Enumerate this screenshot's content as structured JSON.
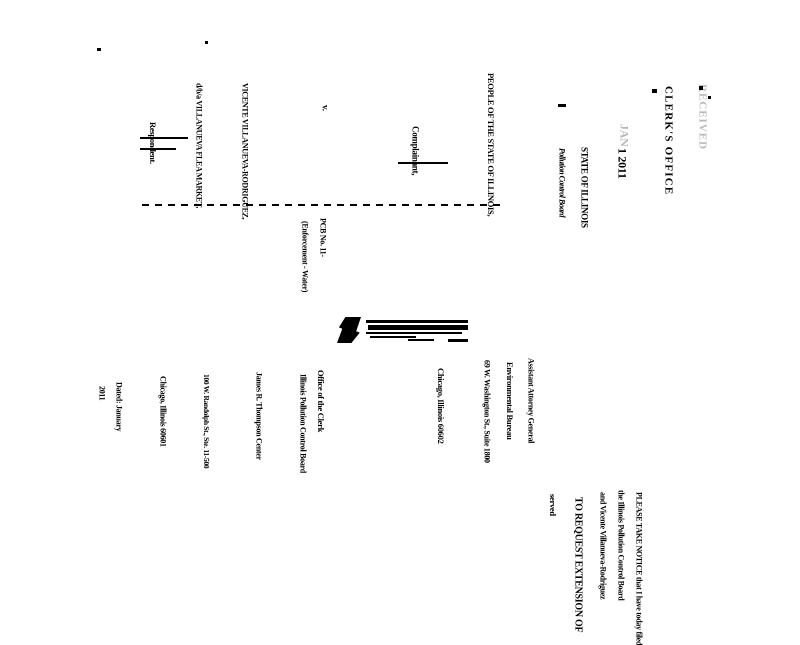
{
  "page": {
    "kind": "scanned legal filing, rotated 90 degrees clockwise",
    "background_color": "#ffffff",
    "ink_color": "#000000"
  },
  "stamp": {
    "received": "RECEIVED",
    "office_line": "CLERK'S OFFICE",
    "date_month": "JAN",
    "date_line": "1 2011",
    "state_line": "STATE OF ILLINOIS",
    "board_line": "Pollution Control Board"
  },
  "caption": {
    "complainant_name": "PEOPLE OF THE STATE OF ILLINOIS,",
    "complainant_label": "Complainant,",
    "versus": "v.",
    "respondent_name": "VICENTE VILLANUEVA-RODRIGUEZ,",
    "respondent_dba": "d/b/a VILLANUEVA FLEA MARKET,",
    "respondent_label": "Respondent."
  },
  "case_ref": {
    "number": "PCB No. 11-",
    "category": "(Enforcement - Water)"
  },
  "notice": {
    "line1": "PLEASE TAKE NOTICE that I have today filed",
    "line2": "the Illinois Pollution Control Board",
    "line3": "and Vicente Villanueva-Rodriguez",
    "line4": "TO REQUEST EXTENSION OF",
    "line5": "served"
  },
  "attorney_address": {
    "line1": "Assistant Attorney General",
    "line2": "Environmental Bureau",
    "line3": "69 W. Washington St., Suite 1800",
    "line4": "Chicago, Illinois 60602"
  },
  "clerk_address": {
    "line1": "Office of the Clerk",
    "line2": "Illinois Pollution Control Board",
    "line3": "James R. Thompson Center",
    "line4": "100 W. Randolph St., Ste. 11-500",
    "line5": "Chicago, Illinois 60601",
    "line6": "Dated: January",
    "line7": "2011"
  }
}
